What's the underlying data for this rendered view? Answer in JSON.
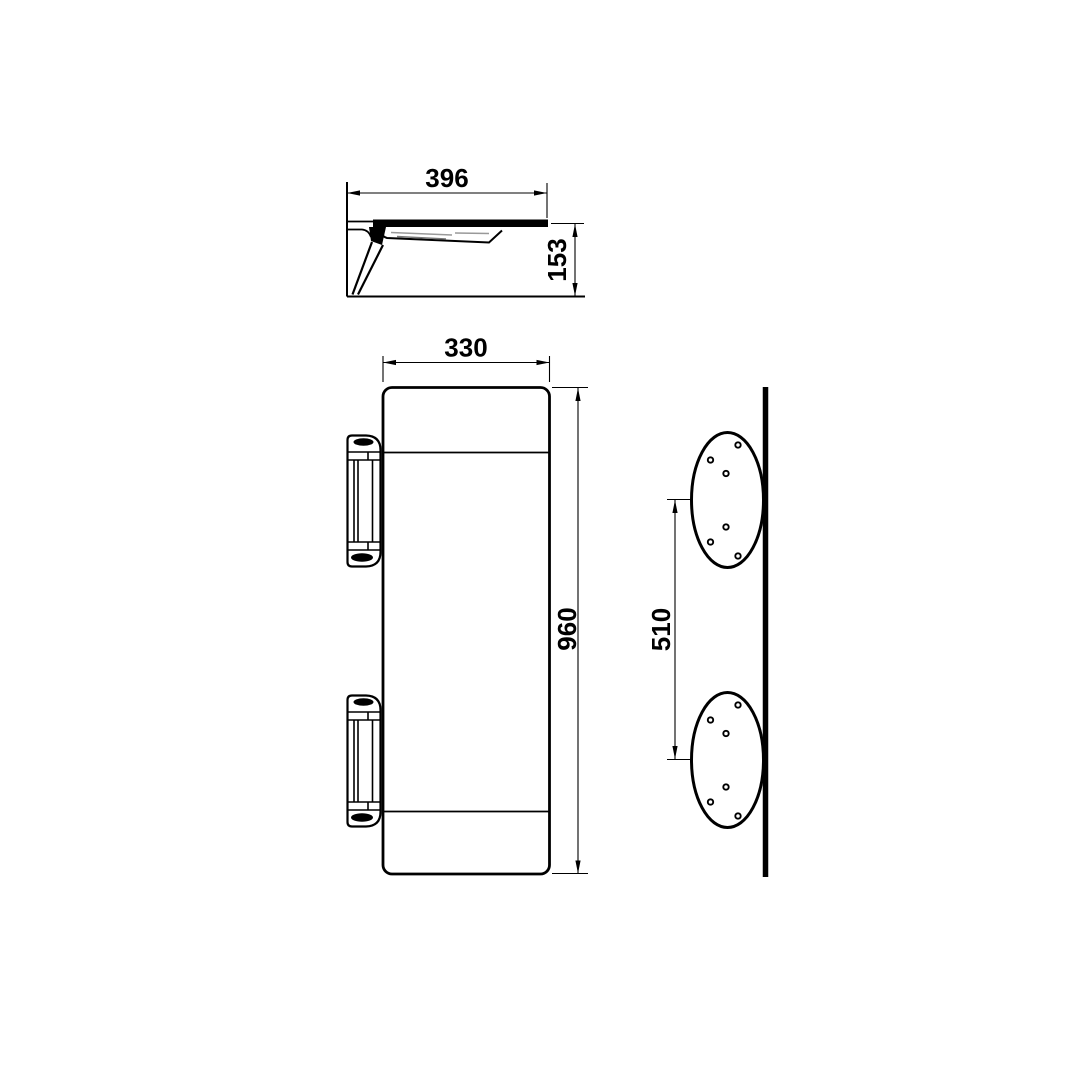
{
  "drawing": {
    "type": "technical-orthographic-drawing",
    "subject": "wall-mounted folding shelf with two round mounting plates",
    "background_color": "#ffffff",
    "line_color": "#000000",
    "dimensions": {
      "profile_width": "396",
      "profile_height": "153",
      "front_width": "330",
      "front_height": "960",
      "plate_spacing": "510"
    }
  }
}
